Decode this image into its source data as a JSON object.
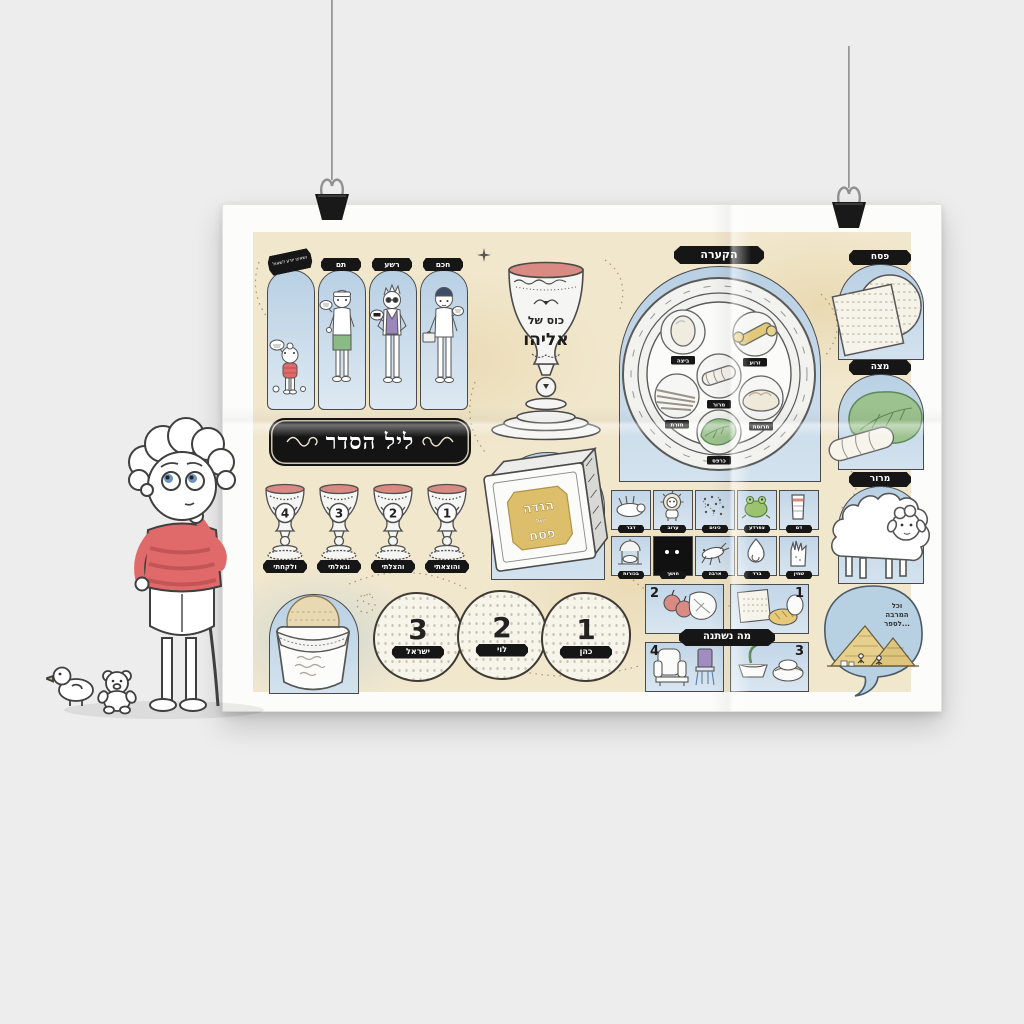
{
  "poster": {
    "title": "ליל הסדר",
    "four_sons": {
      "items": [
        {
          "label": "ושאינו יודע לשאול"
        },
        {
          "label": "תם"
        },
        {
          "label": "רשע"
        },
        {
          "label": "חכם"
        }
      ]
    },
    "elijah_cup": {
      "line1": "כוס של",
      "line2": "אליהו"
    },
    "seder_plate": {
      "title": "הקערה",
      "foods": [
        {
          "name": "ביצה"
        },
        {
          "name": "זרוע"
        },
        {
          "name": "מרור"
        },
        {
          "name": "חזרת"
        },
        {
          "name": "חרוסת"
        },
        {
          "name": "כרפס"
        }
      ]
    },
    "four_cups": {
      "items": [
        {
          "number": "4",
          "label": "ולקחתי"
        },
        {
          "number": "3",
          "label": "וגאלתי"
        },
        {
          "number": "2",
          "label": "והצלתי"
        },
        {
          "number": "1",
          "label": "והוצאתי"
        }
      ]
    },
    "haggadah": {
      "line1": "הגדה",
      "line2": "של",
      "line3": "פסח"
    },
    "plagues": {
      "row1": [
        {
          "name": "דבר"
        },
        {
          "name": "ערוב"
        },
        {
          "name": "כינים"
        },
        {
          "name": "צפרדע"
        },
        {
          "name": "דם"
        }
      ],
      "row2": [
        {
          "name": "בכורות"
        },
        {
          "name": "חושך"
        },
        {
          "name": "ארבה"
        },
        {
          "name": "ברד"
        },
        {
          "name": "שחין"
        }
      ]
    },
    "pesach_matzah_maror": {
      "items": [
        {
          "label": "פסח"
        },
        {
          "label": "מצה"
        },
        {
          "label": "מרור"
        }
      ]
    },
    "three_matzot": {
      "items": [
        {
          "number": "3",
          "label": "ישראל"
        },
        {
          "number": "2",
          "label": "לוי"
        },
        {
          "number": "1",
          "label": "כהן"
        }
      ]
    },
    "ma_nishtana": {
      "title": "מה נשתנה",
      "numbers": [
        "1",
        "2",
        "3",
        "4"
      ]
    },
    "speech_bubble": {
      "lines": [
        "וכל",
        "המרבה",
        "לספר..."
      ]
    },
    "colors": {
      "cream": "#f1e7cd",
      "panel_blue": "#c9dcec",
      "tag_black": "#161616",
      "wine_red": "#d98a82",
      "leaf_green": "#9cc28f",
      "gold": "#ddbe6a",
      "shirt_red": "#e06a6a"
    }
  }
}
